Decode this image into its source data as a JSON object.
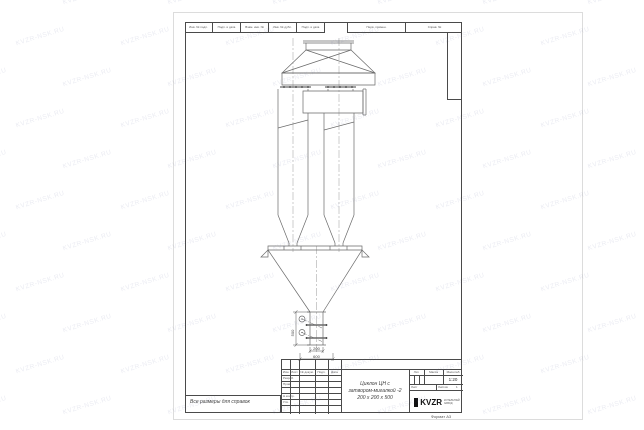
{
  "watermark": {
    "text": "KVZR-NSK.RU"
  },
  "sheet": {
    "top_strip_cells": [
      "Инв. № подл.",
      "Подп. и дата",
      "Взам. инв. №",
      "Инв. № дубл.",
      "Подп. и дата"
    ],
    "top_strip_wide_cells": [
      "Перв. примен.",
      "Справ. №"
    ],
    "note": "Все размеры для справок",
    "format_label": "Формат А3"
  },
  "drawing": {
    "dim_height": "500",
    "dim_width": "200",
    "dim_base": "600"
  },
  "title_block": {
    "header_cols": [
      "Изм.",
      "Лист",
      "№ докум.",
      "Подп.",
      "Дата"
    ],
    "rows": [
      "Разраб.",
      "Пров.",
      "",
      "Н.контр.",
      "Утв."
    ],
    "title_line1": "Циклон ЦН с",
    "title_line2": "затвором-мигалкой -2",
    "title_line3": "200 х 200 х 500",
    "lit_label": "Лит.",
    "mass_label": "Масса",
    "scale_label": "Масштаб",
    "scale_value": "1:20",
    "sheet_label": "Лист",
    "sheets_label": "Листов",
    "sheets_value": "1",
    "company": {
      "logo": "KVZR",
      "line1": "КОТЕЛЬНЫЙ",
      "line2": "ЗАВОД"
    }
  }
}
